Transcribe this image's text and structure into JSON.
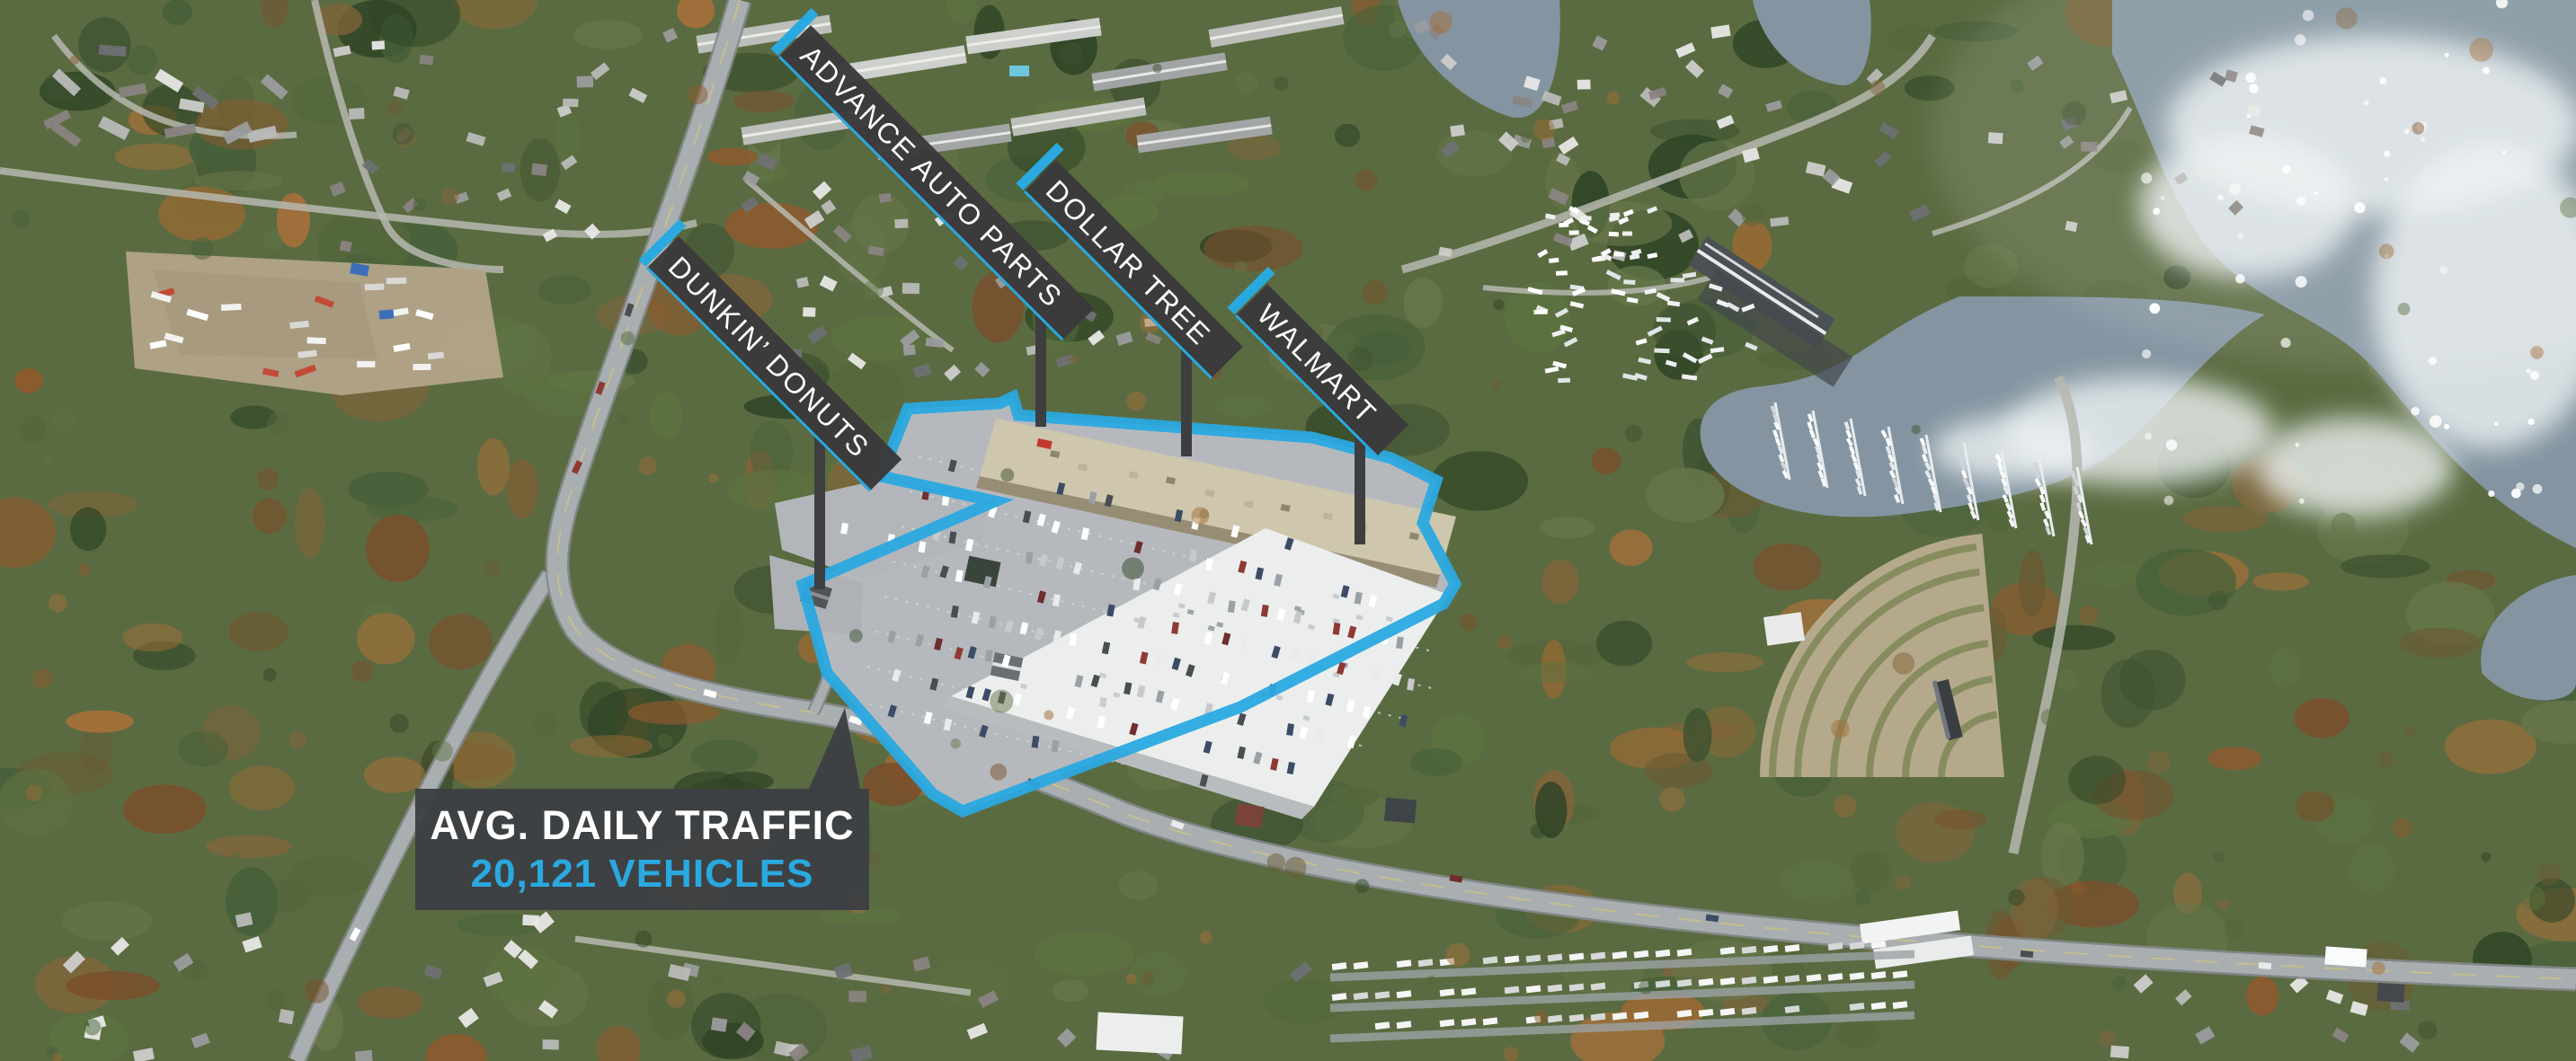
{
  "page": {
    "title": "Retail shopping center aerial with tenant labels"
  },
  "colors": {
    "accent_cyan": "#2aa9e0",
    "label_bar_dark": "#3a3a3b",
    "callout_dark": "#3d4043",
    "text_light": "#ffffff"
  },
  "tenant_labels": [
    {
      "id": "dunkin-donuts",
      "text": "DUNKIN’ DONUTS"
    },
    {
      "id": "advance-auto-parts",
      "text": "ADVANCE AUTO PARTS"
    },
    {
      "id": "dollar-tree",
      "text": "DOLLAR TREE"
    },
    {
      "id": "walmart",
      "text": "WALMART"
    }
  ],
  "traffic_callout": {
    "heading": "AVG. DAILY TRAFFIC",
    "value": "20,121 VEHICLES"
  }
}
